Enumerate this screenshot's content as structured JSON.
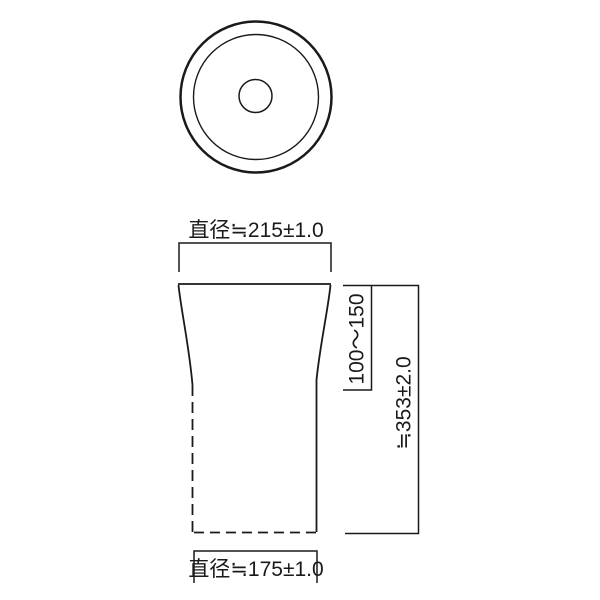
{
  "colors": {
    "line": "#1a1a1a",
    "background": "#ffffff"
  },
  "dimensions": {
    "top_diameter": {
      "label": "直径≒215±1.0"
    },
    "bottom_diameter": {
      "label": "直径≒175±1.0"
    },
    "flare_height": {
      "label": "100〜150"
    },
    "overall_height": {
      "label": "≒353±2.0"
    }
  }
}
